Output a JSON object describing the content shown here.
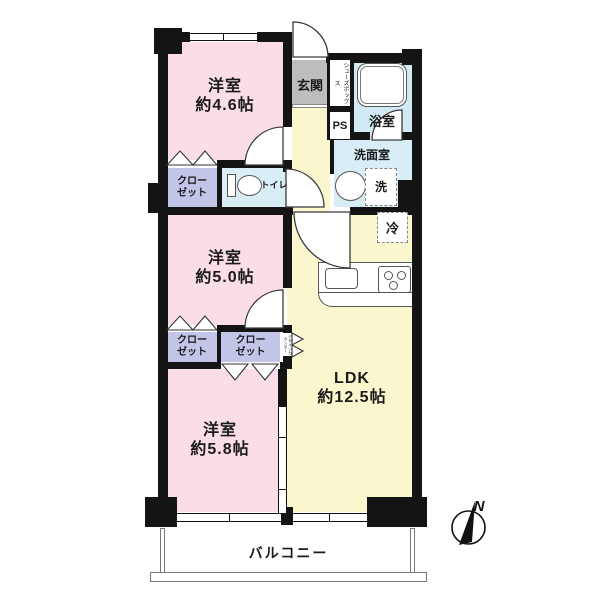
{
  "floorplan": {
    "rooms": {
      "bedroom_top": {
        "name": "洋室",
        "size": "約4.6帖"
      },
      "bedroom_mid": {
        "name": "洋室",
        "size": "約5.0帖"
      },
      "bedroom_bottom": {
        "name": "洋室",
        "size": "約5.8帖"
      },
      "ldk": {
        "name": "LDK",
        "size": "約12.5帖"
      },
      "entrance": "玄関",
      "shoe_box": "シューズボックス",
      "pipe_space": "PS",
      "bathroom": "浴室",
      "washroom": "洗面室",
      "washer": "洗",
      "refrigerator": "冷",
      "toilet": "トイレ",
      "closet": {
        "line1": "クロー",
        "line2": "ゼット"
      },
      "design_counter": "デザインカウンター",
      "balcony": "バルコニー"
    },
    "compass": {
      "north": "N"
    },
    "colors": {
      "wall": "#141414",
      "bedroom": "#fadde7",
      "ldk": "#faf7cf",
      "wet": "#d9edf7",
      "bath": "#d2eaf4",
      "closet": "#c2c4e8",
      "entrance": "#bdbdbd"
    }
  }
}
